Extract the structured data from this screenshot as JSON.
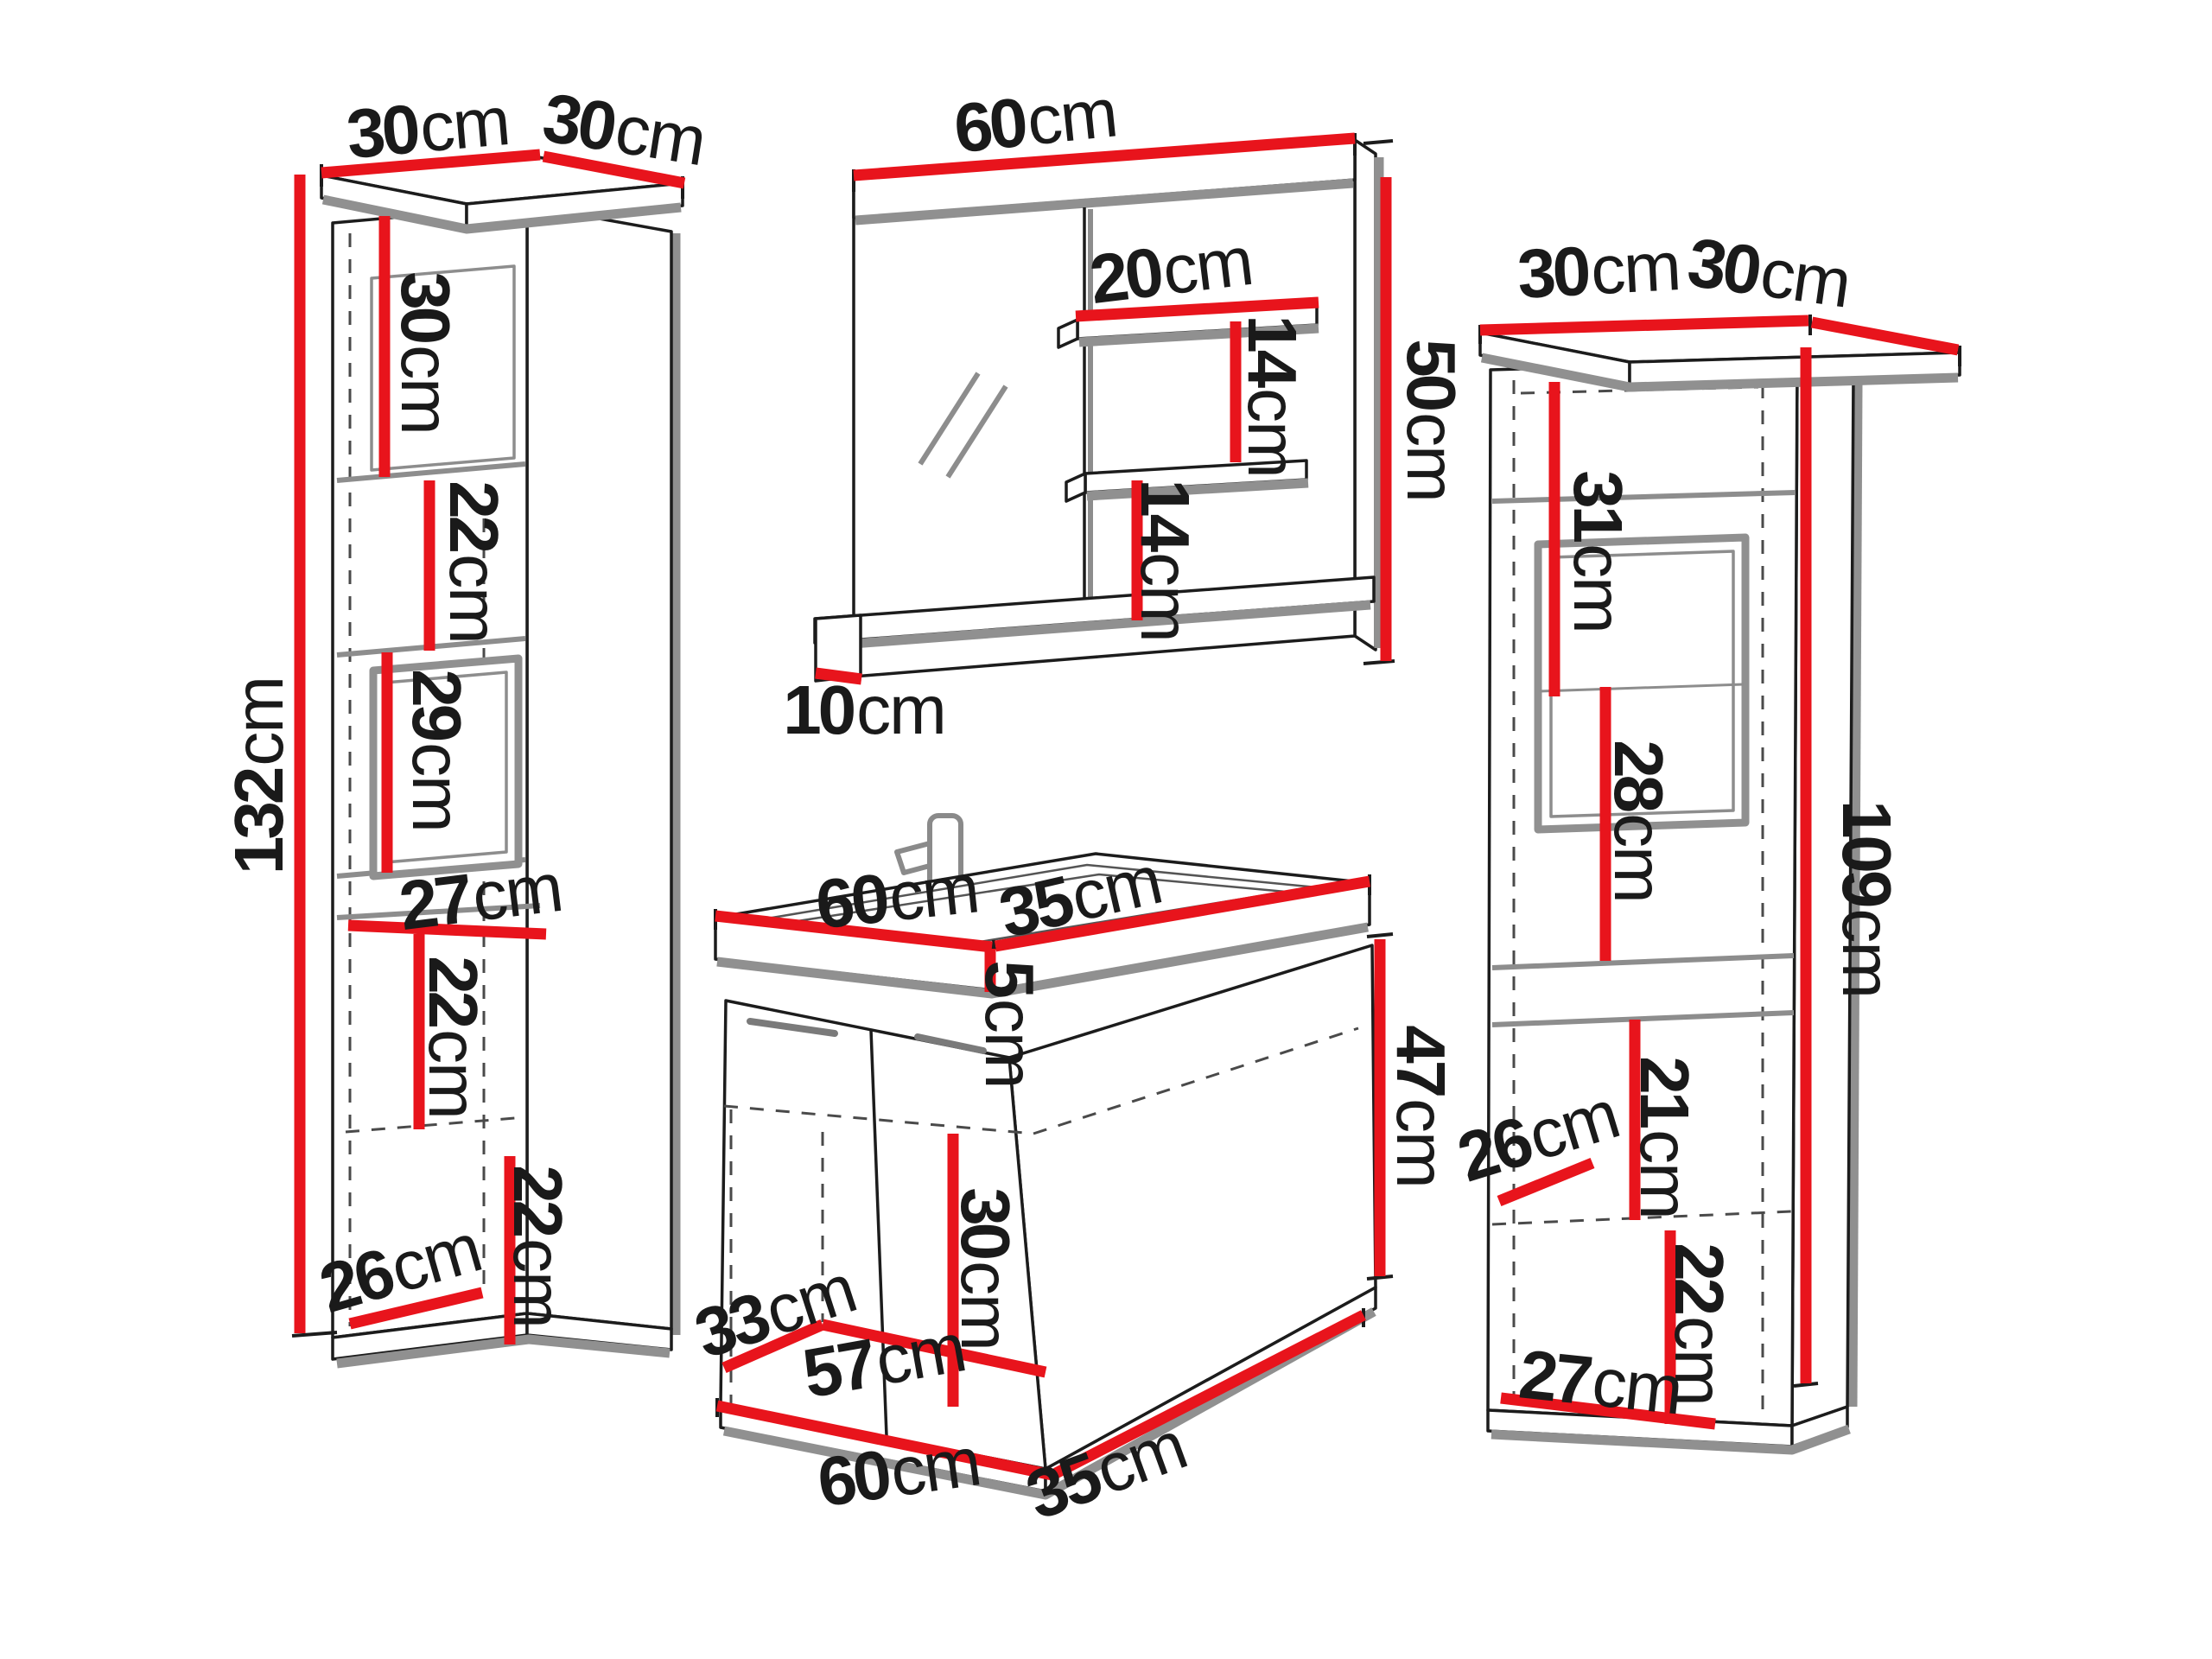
{
  "unit": "cm",
  "colors": {
    "dimension_red": "#e8141c",
    "outline_black": "#1c1c1c",
    "shadow_gray": "#909090",
    "background": "#ffffff"
  },
  "left_cabinet": {
    "width": "30",
    "depth": "30",
    "height": "132",
    "sections": [
      "30",
      "22",
      "29",
      "27",
      "22",
      "22",
      "26"
    ]
  },
  "mirror": {
    "width": "60",
    "height": "50",
    "shelf_width": "20",
    "shelf_spacing": [
      "14",
      "14"
    ],
    "bottom_shelf_depth": "10"
  },
  "vanity": {
    "top_width": "60",
    "top_depth": "35",
    "basin_height": "5",
    "cabinet_height": "47",
    "inner_height": "30",
    "inner_depth": "33",
    "inner_width": "57",
    "bottom_width": "60",
    "bottom_depth": "35"
  },
  "right_cabinet": {
    "width": "30",
    "depth": "30",
    "height": "109",
    "sections": [
      "31",
      "28",
      "21",
      "26",
      "22",
      "27"
    ]
  }
}
